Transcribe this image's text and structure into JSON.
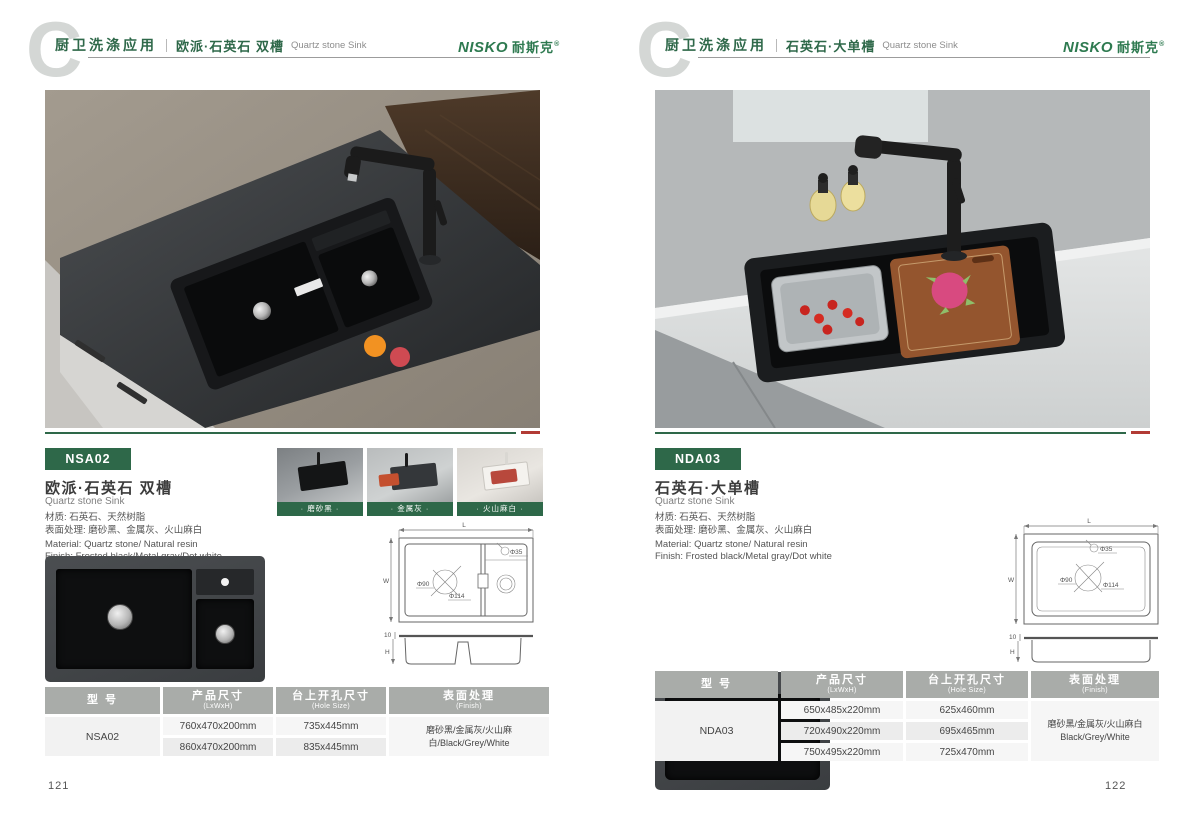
{
  "colors": {
    "brand_green": "#2e6849",
    "logo_green": "#2e7a50",
    "accent_red": "#b23b35",
    "table_header_gray": "#a9aca9"
  },
  "page_left": {
    "header": {
      "category": "厨卫洗涤应用",
      "series": "欧派·石英石 双槽",
      "series_en": "Quartz stone Sink"
    },
    "logo": {
      "name": "NISKO",
      "cn": "耐斯克",
      "mark": "®"
    },
    "product": {
      "code": "NSA02",
      "title": "欧派·石英石 双槽",
      "title_en": "Quartz stone Sink",
      "material_cn": "材质: 石英石、天然树脂",
      "finish_cn": "表面处理: 磨砂黑、金属灰、火山麻白",
      "material_en": "Material: Quartz stone/ Natural resin",
      "finish_en": "Finish: Frosted black/Metal gray/Dot white"
    },
    "swatches": [
      {
        "label": "· 磨砂黑 ·"
      },
      {
        "label": "· 金属灰 ·"
      },
      {
        "label": "· 火山麻白 ·"
      }
    ],
    "drawing": {
      "length": "L",
      "width": "W",
      "height": "H",
      "lip": "10",
      "faucet_hole": "Φ35",
      "drain_inner": "Φ90",
      "drain_outer": "Φ114"
    },
    "table": {
      "headers": {
        "model_cn": "型 号",
        "size_cn": "产品尺寸",
        "size_en": "(LxWxH)",
        "hole_cn": "台上开孔尺寸",
        "hole_en": "(Hole Size)",
        "finish_cn": "表面处理",
        "finish_en": "(Finish)"
      },
      "model": "NSA02",
      "rows": [
        {
          "size": "760x470x200mm",
          "hole": "735x445mm"
        },
        {
          "size": "860x470x200mm",
          "hole": "835x445mm"
        }
      ],
      "finish_lines": [
        "磨砂黑/金属灰/火山麻白/Black/Grey/White"
      ]
    },
    "page_number": "121"
  },
  "page_right": {
    "header": {
      "category": "厨卫洗涤应用",
      "series": "石英石·大单槽",
      "series_en": "Quartz stone Sink"
    },
    "logo": {
      "name": "NISKO",
      "cn": "耐斯克",
      "mark": "®"
    },
    "product": {
      "code": "NDA03",
      "title": "石英石·大单槽",
      "title_en": "Quartz stone Sink",
      "material_cn": "材质: 石英石、天然树脂",
      "finish_cn": "表面处理: 磨砂黑、金属灰、火山麻白",
      "material_en": "Material: Quartz stone/ Natural resin",
      "finish_en": "Finish: Frosted black/Metal gray/Dot white"
    },
    "drawing": {
      "length": "L",
      "width": "W",
      "height": "H",
      "lip": "10",
      "faucet_hole": "Φ35",
      "drain_inner": "Φ90",
      "drain_outer": "Φ114"
    },
    "table": {
      "headers": {
        "model_cn": "型 号",
        "size_cn": "产品尺寸",
        "size_en": "(LxWxH)",
        "hole_cn": "台上开孔尺寸",
        "hole_en": "(Hole Size)",
        "finish_cn": "表面处理",
        "finish_en": "(Finish)"
      },
      "model": "NDA03",
      "rows": [
        {
          "size": "650x485x220mm",
          "hole": "625x460mm"
        },
        {
          "size": "720x490x220mm",
          "hole": "695x465mm"
        },
        {
          "size": "750x495x220mm",
          "hole": "725x470mm"
        }
      ],
      "finish_lines": [
        "磨砂黑/金属灰/火山麻白",
        "Black/Grey/White"
      ]
    },
    "page_number": "122"
  }
}
